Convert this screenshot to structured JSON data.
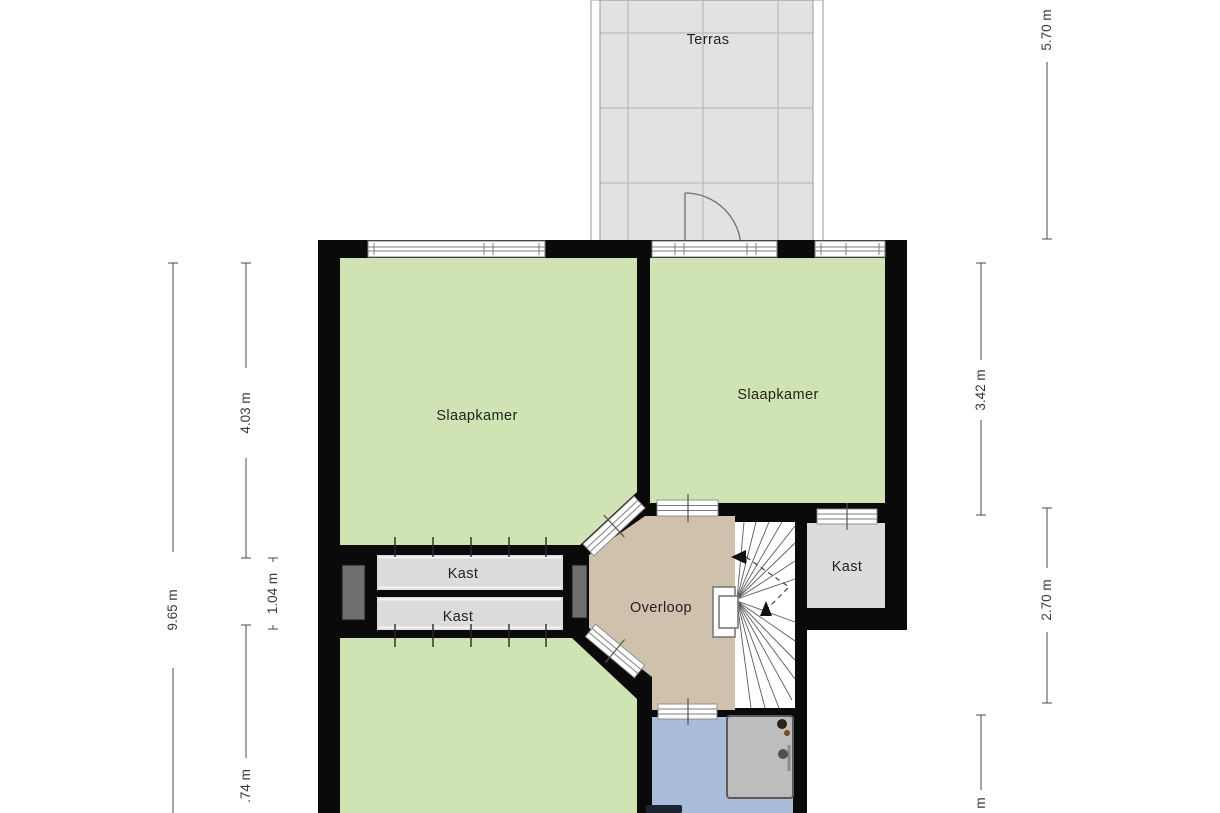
{
  "rooms": {
    "terras": "Terras",
    "slaapkamer_left": "Slaapkamer",
    "slaapkamer_right": "Slaapkamer",
    "kast_upper": "Kast",
    "kast_lower": "Kast",
    "kast_right": "Kast",
    "overloop": "Overloop"
  },
  "dimensions": {
    "left_outer_height": "9.65 m",
    "left_bedroom_depth": "4.03 m",
    "left_closet_depth": "1.04 m",
    "left_bottom_partial": ".74 m",
    "right_terrace_depth": "5.70 m",
    "right_bedroom_depth": "3.42 m",
    "right_middle_depth": "2.70 m",
    "right_bottom_partial": "m"
  },
  "colors": {
    "room_green": "#cfe3b3",
    "landing_tan": "#d0c1ad",
    "bathroom_blue": "#a9bdd9",
    "closet_gray": "#dcdcdc",
    "terrace_gray": "#e2e2e2",
    "duct_gray": "#6f6f6f",
    "wall_black": "#0a0a0a"
  }
}
